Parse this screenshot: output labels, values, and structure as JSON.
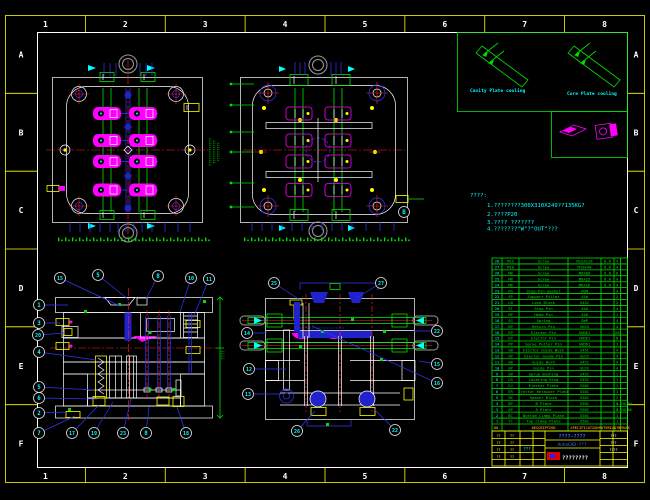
{
  "frame": {
    "columns": [
      "1",
      "2",
      "3",
      "4",
      "5",
      "6",
      "7",
      "8"
    ],
    "rows": [
      "A",
      "B",
      "C",
      "D",
      "E",
      "F"
    ]
  },
  "inset": {
    "label_left": "Cavity Plate cooling",
    "label_right": "Core Plate cooling"
  },
  "notes": {
    "title": "????:",
    "lines": [
      "1.????????300X310X249??135KG?",
      "2.????P20",
      "3.???? ???????",
      "4.???????\"W\"?\"OUT\"???"
    ]
  },
  "bom": {
    "headers": [
      "NO.",
      "DESCRIPTION",
      "SPECIFICATION",
      "MATERIAL",
      "QTY",
      "REMARK"
    ],
    "rows": [
      [
        "28",
        "M12",
        "Screw",
        "M12X110",
        "8.8",
        "4",
        ""
      ],
      [
        "27",
        "M10",
        "Screw",
        "M10X40",
        "8.8",
        "4",
        ""
      ],
      [
        "26",
        "M8",
        "Screw",
        "M8X80",
        "8.8",
        "6",
        ""
      ],
      [
        "25",
        "M8",
        "Screw",
        "M8X25",
        "8.8",
        "4",
        ""
      ],
      [
        "24",
        "M6",
        "Screw",
        "M6X16",
        "8.8",
        "4",
        ""
      ],
      [
        "23",
        "PG",
        "Stop-Pin Gasket",
        "POM",
        "",
        "4",
        ""
      ],
      [
        "22",
        "SP",
        "Support Pillar",
        "45#",
        "",
        "2",
        ""
      ],
      [
        "21",
        "LB",
        "Lock Block",
        "S45C",
        "",
        "2",
        ""
      ],
      [
        "20",
        "ST",
        "Stop Pin",
        "45#",
        "",
        "4",
        ""
      ],
      [
        "19",
        "HP",
        "Head Pin",
        "45#",
        "",
        "1",
        ""
      ],
      [
        "18",
        "SG",
        "Spring",
        "SWP",
        "",
        "4",
        ""
      ],
      [
        "17",
        "RP",
        "Return Pin",
        "SKS3",
        "",
        "4",
        ""
      ],
      [
        "16",
        "EP",
        "Ejector Pin",
        "SKD61",
        "",
        "20",
        ""
      ],
      [
        "15",
        "EP",
        "Ejector Pin",
        "SKD61",
        "",
        "8",
        ""
      ],
      [
        "14",
        "PP",
        "Sprue Puller Pin",
        "SKD61",
        "",
        "1",
        ""
      ],
      [
        "13",
        "GB",
        "Ejector Guide Bush",
        "S45C",
        "",
        "4",
        ""
      ],
      [
        "12",
        "GP",
        "Ejector Guide Pin",
        "SUJ2",
        "",
        "4",
        ""
      ],
      [
        "11",
        "GB",
        "Guide Bush",
        "S45C",
        "",
        "4",
        ""
      ],
      [
        "10",
        "GP",
        "Guide Pin",
        "SUJ2",
        "",
        "4",
        ""
      ],
      [
        "9",
        "SB",
        "Sprue Bushing",
        "S45C",
        "",
        "1",
        ""
      ],
      [
        "8",
        "LR",
        "Locating Ring",
        "S45C",
        "",
        "1",
        ""
      ],
      [
        "7",
        "EJ",
        "Ejector Plate",
        "S50C",
        "",
        "1",
        ""
      ],
      [
        "6",
        "ER",
        "Ejector Retainer Plate",
        "S50C",
        "",
        "1",
        ""
      ],
      [
        "5",
        "SK",
        "Spacer Block",
        "S50C",
        "",
        "2",
        ""
      ],
      [
        "4",
        "BP",
        "B Plate",
        "S50C",
        "",
        "1",
        "0-350-80"
      ],
      [
        "3",
        "AP",
        "A Plate",
        "S50C",
        "",
        "1",
        "0-350-60"
      ],
      [
        "2",
        "BC",
        "Bottom Clamp Plate",
        "S50C",
        "",
        "1",
        ""
      ],
      [
        "1",
        "TC",
        "Top Clamp Plate",
        "S50C",
        "",
        "1",
        ""
      ]
    ]
  },
  "title_block": {
    "drawing_title": "????-????",
    "software": "AutoCAD-???",
    "company": "????????",
    "check_note": "???",
    "left_labels": [
      "??",
      "??",
      "??",
      "??",
      "??",
      "??",
      "??",
      "??"
    ],
    "right_labels": [
      "???",
      "???",
      "????"
    ]
  },
  "dims": {
    "plan1_right": [
      "?????????????",
      "???????????",
      "?????????"
    ],
    "lv_right": "????"
  },
  "balloons": {
    "left_view": [
      {
        "label": "15",
        "x": 60,
        "y": 278,
        "tx": 120,
        "ty": 306
      },
      {
        "label": "5",
        "x": 98,
        "y": 275,
        "tx": 129,
        "ty": 300
      },
      {
        "label": "8",
        "x": 158,
        "y": 276,
        "tx": 146,
        "ty": 299
      },
      {
        "label": "10",
        "x": 191,
        "y": 278,
        "tx": 180,
        "ty": 312
      },
      {
        "label": "11",
        "x": 209,
        "y": 279,
        "tx": 193,
        "ty": 318
      },
      {
        "label": "1",
        "x": 39,
        "y": 305,
        "tx": 68,
        "ty": 305
      },
      {
        "label": "3",
        "x": 39,
        "y": 323,
        "tx": 60,
        "ty": 323
      },
      {
        "label": "20",
        "x": 38,
        "y": 335,
        "tx": 64,
        "ty": 333
      },
      {
        "label": "4",
        "x": 39,
        "y": 352,
        "tx": 96,
        "ty": 360
      },
      {
        "label": "5",
        "x": 39,
        "y": 387,
        "tx": 94,
        "ty": 390
      },
      {
        "label": "6",
        "x": 39,
        "y": 398,
        "tx": 97,
        "ty": 399
      },
      {
        "label": "2",
        "x": 39,
        "y": 413,
        "tx": 66,
        "ty": 412
      },
      {
        "label": "7",
        "x": 39,
        "y": 433,
        "tx": 75,
        "ty": 416
      },
      {
        "label": "17",
        "x": 72,
        "y": 433,
        "tx": 99,
        "ty": 405
      },
      {
        "label": "19",
        "x": 94,
        "y": 433,
        "tx": 113,
        "ty": 402
      },
      {
        "label": "23",
        "x": 123,
        "y": 433,
        "tx": 131,
        "ty": 399
      },
      {
        "label": "8",
        "x": 146,
        "y": 433,
        "tx": 149,
        "ty": 407
      },
      {
        "label": "18",
        "x": 186,
        "y": 433,
        "tx": 177,
        "ty": 407
      }
    ],
    "middle_view": [
      {
        "label": "25",
        "x": 274,
        "y": 283,
        "tx": 300,
        "ty": 300
      },
      {
        "label": "27",
        "x": 381,
        "y": 283,
        "tx": 358,
        "ty": 297
      },
      {
        "label": "14",
        "x": 247,
        "y": 333,
        "tx": 267,
        "ty": 333
      },
      {
        "label": "12",
        "x": 249,
        "y": 369,
        "tx": 286,
        "ty": 369
      },
      {
        "label": "13",
        "x": 248,
        "y": 394,
        "tx": 281,
        "ty": 394
      },
      {
        "label": "22",
        "x": 437,
        "y": 331,
        "tx": 414,
        "ty": 331
      },
      {
        "label": "15",
        "x": 437,
        "y": 364,
        "tx": 419,
        "ty": 361
      },
      {
        "label": "16",
        "x": 437,
        "y": 383,
        "tx": 312,
        "ty": 326
      },
      {
        "label": "26",
        "x": 297,
        "y": 431,
        "tx": 315,
        "ty": 411
      },
      {
        "label": "22",
        "x": 395,
        "y": 430,
        "tx": 374,
        "ty": 409
      }
    ],
    "plan2": [
      {
        "label": "B",
        "x": 404,
        "y": 212,
        "tx": 404,
        "ty": 212
      }
    ]
  }
}
